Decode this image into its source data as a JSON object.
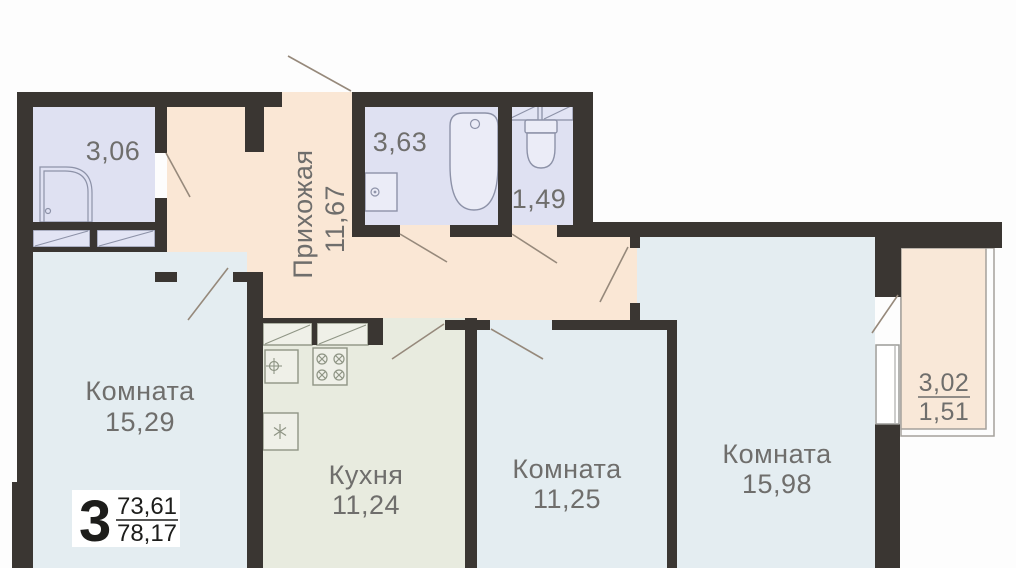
{
  "badge": {
    "number": "3",
    "area_living": "73,61",
    "area_total": "78,17"
  },
  "rooms": {
    "shower_room": {
      "area": "3,06"
    },
    "hallway": {
      "name": "Прихожая",
      "area": "11,67"
    },
    "bathroom": {
      "area": "3,63"
    },
    "wc": {
      "area": "1,49"
    },
    "living_left": {
      "name": "Комната",
      "area": "15,29"
    },
    "kitchen": {
      "name": "Кухня",
      "area": "11,24"
    },
    "living_middle": {
      "name": "Комната",
      "area": "11,25"
    },
    "living_right": {
      "name": "Комната",
      "area": "15,98"
    },
    "balcony": {
      "area_total": "3,02",
      "area_counted": "1,51"
    }
  },
  "colors": {
    "wall": "#3a3632",
    "hallway": "#fae7d5",
    "wet": "#dfe1f2",
    "living": "#e4edf1",
    "kitchen": "#e8ebdf",
    "balcony": "#f9e8d8",
    "label_text": "#6f6e6c",
    "badge_text": "#1d1d1b"
  }
}
